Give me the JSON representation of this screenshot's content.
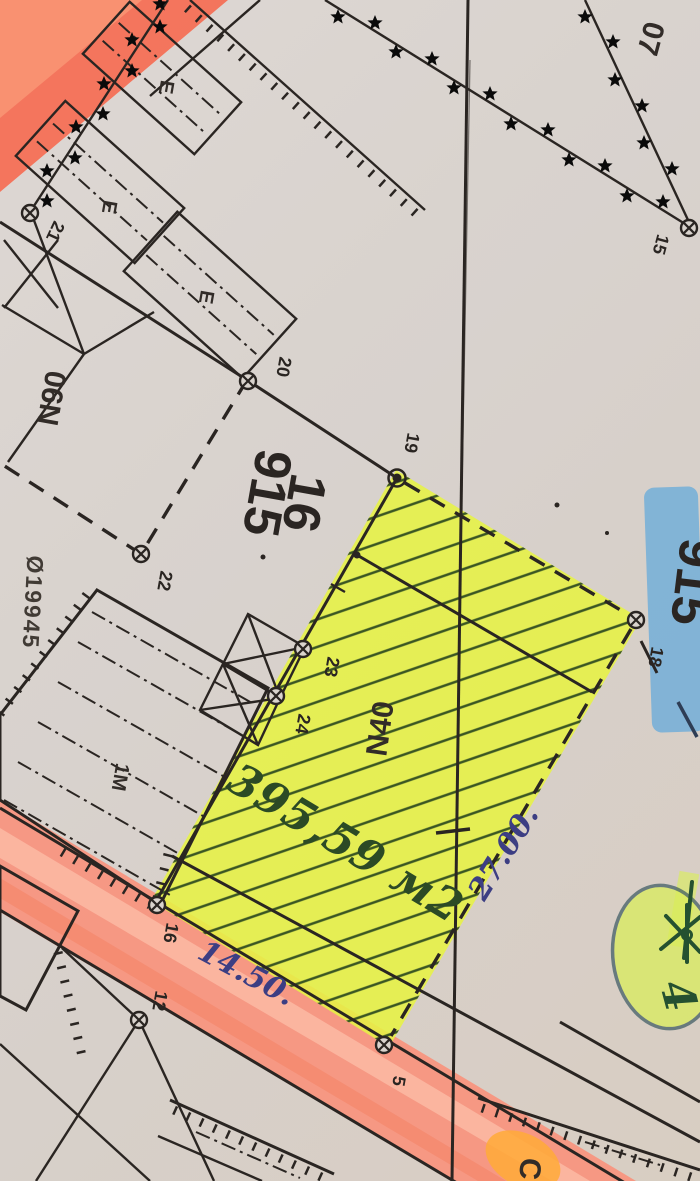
{
  "map": {
    "block_numbers": {
      "top_right": "07"
    },
    "parcel": {
      "number_large": "915",
      "number_sub": "16",
      "number_highlighted": "915",
      "plot_label": "N40",
      "neighbor_label": "N90",
      "ref_code": "Ø19945"
    },
    "points": {
      "p5": "5",
      "p12": "12",
      "p15": "15",
      "p16": "16",
      "p18": "18",
      "p19": "19",
      "p20": "20",
      "p21": "21",
      "p22": "22",
      "p23": "23",
      "p24": "24"
    },
    "buildings": {
      "e1": "E",
      "e2": "E",
      "e3": "E",
      "story_label": "1M"
    },
    "handwriting": {
      "area_value": "395,59 м2",
      "length_side": "27.00.",
      "length_road": "14.50.",
      "circled_number": "4",
      "highlighted_letter": "C"
    },
    "colors": {
      "plot_highlight": "#e6f23e",
      "road_highlight": "#f8907a",
      "road_streak": "#fdb9a4",
      "corner_highlight": "#f46a50",
      "blue_highlight": "#66a9d8",
      "green_circle_highlight": "#d9ee4f",
      "orange_letter_highlight": "#ffa733",
      "ink_blue": "#35377e",
      "ink_green": "#24431d",
      "print_black": "#221d19"
    }
  }
}
